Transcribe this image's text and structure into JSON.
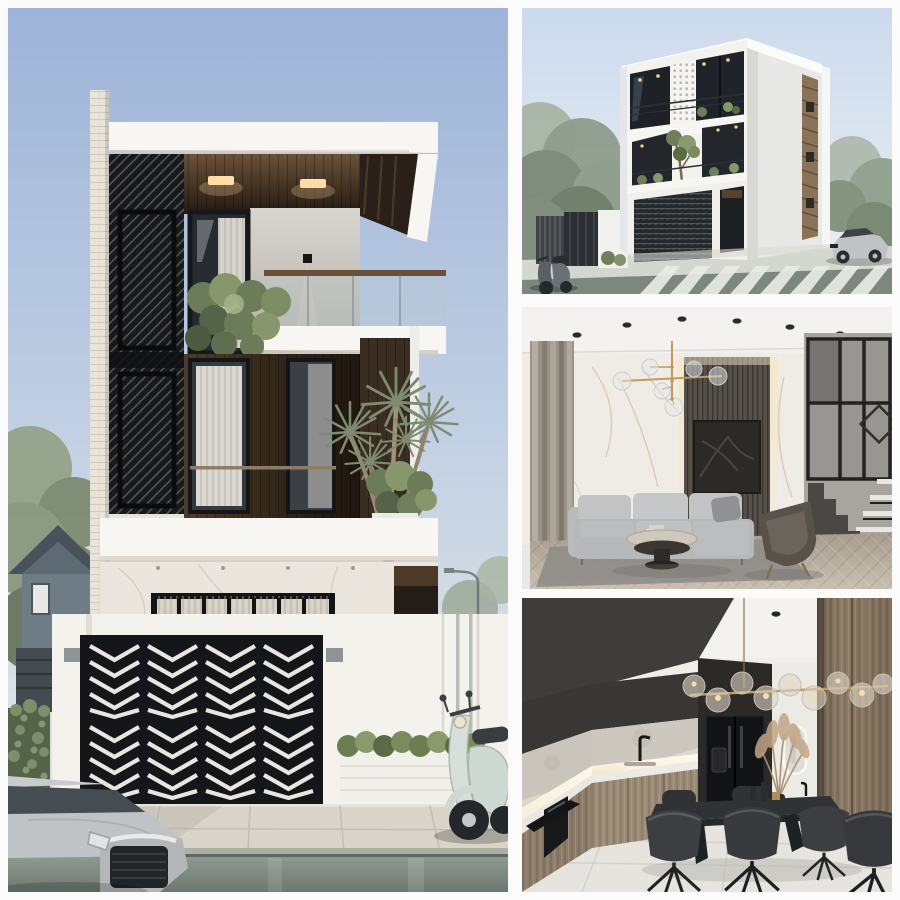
{
  "collage": {
    "kind": "architecture-render-photo-collage",
    "panels": {
      "front": {
        "alt": "Street elevation of a modern three-storey house with black diagonal screens, wood cladding, glass balcony and a black chevron-patterned gate"
      },
      "perspective": {
        "alt": "Corner perspective render of the same white modern house with dark glass, street crosswalk and parked car"
      },
      "living": {
        "alt": "Living room interior with marble wall, dark slat feature wall, grey sectional sofa and black steel staircase"
      },
      "kitchen": {
        "alt": "Kitchen and dining interior with wood cabinets, black fridge, stone dining table and brass globe chandelier"
      }
    }
  },
  "palette": {
    "gutter-white": "#fbfbfb",
    "sky-deep": "#9db3d8",
    "sky-pale": "#dbe3ec",
    "white-facade": "#f7f6f3",
    "marble-wall": "#eae6dd",
    "brick-pale": "#e9e4da",
    "screen-black": "#17191b",
    "gate-black": "#14161a",
    "gate-cut-white": "#e9e6df",
    "wood-dark": "#33271a",
    "soffit-light": "#ffdda6",
    "foliage-green": "#76846b",
    "hedge-green": "#6d7d52",
    "fence-white": "#f4f2ec",
    "sidewalk-grey": "#d8d4ca",
    "road-grey": "#7d877f",
    "car-silver": "#c0c3c5",
    "scooter-mint": "#cfd9d3",
    "interior-ceiling": "#f3f2f0",
    "marble-interior": "#efece6",
    "slat-wall": "#55504a",
    "artwork-black": "#2c2a27",
    "sofa-grey": "#b7b8b9",
    "armchair-taupe": "#58524b",
    "rug-grey": "#8f8d88",
    "floor-wood": "#bdb2a3",
    "stair-steel": "#4a4845",
    "brass-gold": "#bf9a5c",
    "kitchen-dark": "#383735",
    "fridge-black": "#121315",
    "cabinet-wood": "#9b8a76",
    "concrete-splash": "#c9c5bc",
    "table-stone": "#303335",
    "chair-dark": "#3d3e41",
    "tile-floor": "#e6e4df",
    "pampas-tan": "#c2a585"
  }
}
